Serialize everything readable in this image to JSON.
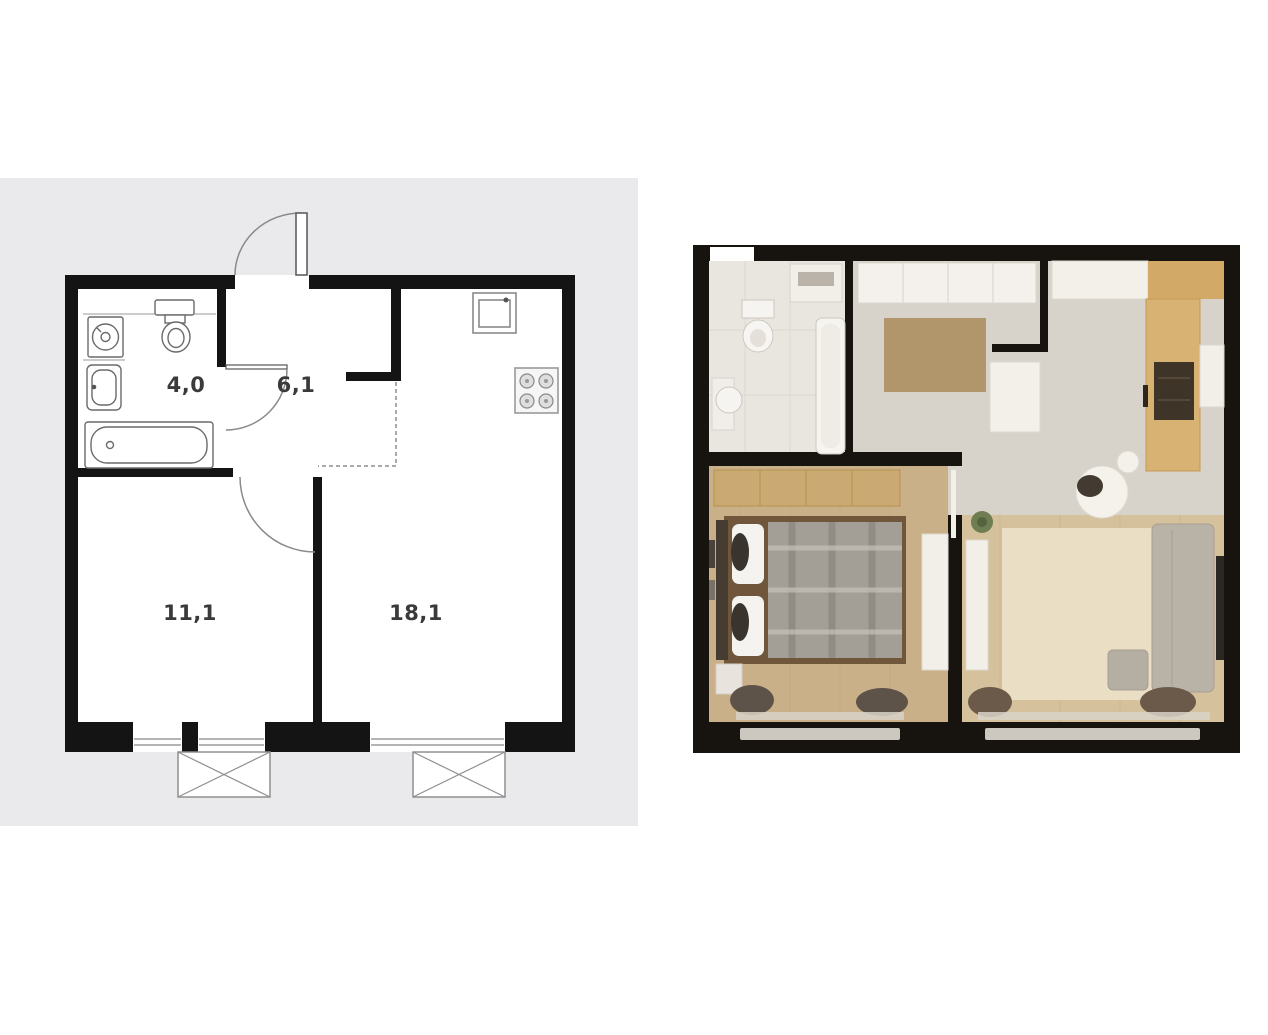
{
  "page": {
    "background": "#ffffff"
  },
  "left_panel": {
    "background": "#eaeaec",
    "plan": {
      "wall_color": "#141414",
      "fixture_line_color": "#6a6a6a",
      "label_color": "#3a3a3a",
      "rooms": [
        {
          "name": "bathroom",
          "area_label": "4,0"
        },
        {
          "name": "hallway",
          "area_label": "6,1"
        },
        {
          "name": "bedroom",
          "area_label": "11,1"
        },
        {
          "name": "living-kitchen",
          "area_label": "18,1"
        }
      ],
      "fixtures": [
        "washing-machine",
        "toilet",
        "sink",
        "bathtub",
        "kitchen-sink",
        "stove"
      ],
      "markers": [
        "entrance-door",
        "bathroom-door",
        "room-door",
        "kitchen-zone-dashed-line",
        "windows",
        "balcony-boxes"
      ]
    }
  },
  "right_panel": {
    "render": {
      "wall_color": "#17140f",
      "floor_colors": {
        "bathroom": "#e9e5df",
        "hall_kitchen": "#d8d3ca",
        "bedroom": "#c9b089",
        "living": "#d5c29d"
      },
      "accent_colors": {
        "bedroom_rug": "#b2966b",
        "living_rug": "#eadfc4",
        "wood_cabinet": "#d2a967",
        "stove_dark": "#3f3428"
      }
    }
  }
}
